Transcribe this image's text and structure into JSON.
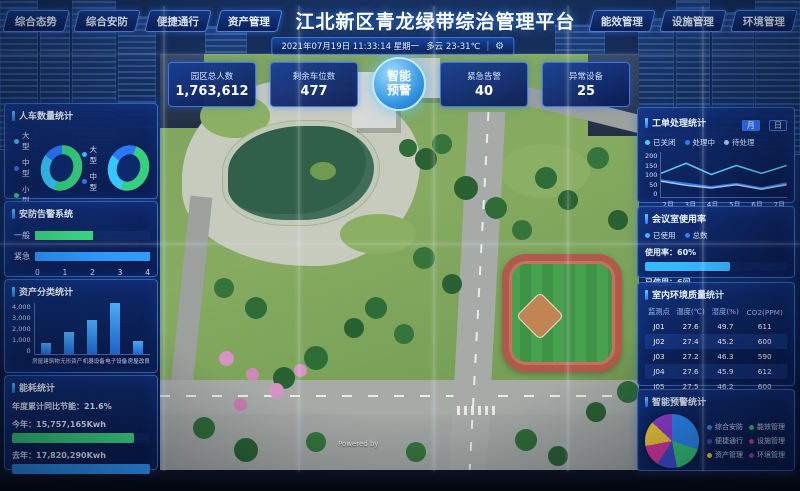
{
  "header": {
    "title": "江北新区青龙绿带综治管理平台",
    "tabs_left": [
      "综合态势",
      "综合安防",
      "便捷通行",
      "资产管理"
    ],
    "tabs_right": [
      "能效管理",
      "设施管理",
      "环境管理"
    ],
    "datetime": "2021年07月19日 11:33:14 星期一",
    "weather": "多云 23-31℃"
  },
  "kpis": {
    "park_total_people": {
      "label": "园区总人数",
      "value": "1,763,612"
    },
    "parking_remaining": {
      "label": "剩余车位数",
      "value": "477"
    },
    "smart_alert": {
      "line1": "智能",
      "line2": "预警"
    },
    "emergency_alarms": {
      "label": "紧急告警",
      "value": "40"
    },
    "abnormal_devices": {
      "label": "异常设备",
      "value": "25"
    }
  },
  "panels": {
    "people_vehicle": {
      "title": "人车数量统计"
    },
    "security_alarm": {
      "title": "安防告警系统"
    },
    "asset_category": {
      "title": "资产分类统计"
    },
    "energy": {
      "title": "能耗统计",
      "yoy": "年度累计同比节能：21.6%",
      "this_year_label": "今年：15,757,165Kwh",
      "last_year_label": "去年：17,820,290Kwh"
    },
    "work_order": {
      "title": "工单处理统计",
      "toggle_month": "月",
      "toggle_day": "日"
    },
    "meeting_room": {
      "title": "会议室使用率",
      "legend_used": "已使用",
      "legend_total": "总数",
      "usage_label": "使用率：60%",
      "used_label": "已使用：6间"
    },
    "indoor_env": {
      "title": "室内环境质量统计"
    },
    "smart_warning": {
      "title": "智能预警统计"
    }
  },
  "map": {
    "watermark": "Powered by"
  },
  "colors": {
    "accent": "#2f6fff",
    "panel_border": "#5f9bff",
    "alert_button": "#3497e2"
  },
  "chart_data": [
    {
      "type": "pie",
      "name": "人车数量统计-车辆左",
      "donut": true,
      "labels": [
        "大型",
        "中型",
        "小型"
      ],
      "values": [
        30,
        15,
        55
      ],
      "colors": [
        "#35c8ff",
        "#2979ff",
        "#35d07f"
      ]
    },
    {
      "type": "pie",
      "name": "人车数量统计-车辆右",
      "donut": true,
      "labels": [
        "大型",
        "中型"
      ],
      "values": [
        30,
        20,
        50
      ],
      "colors": [
        "#35c8ff",
        "#2979ff",
        "#35d07f"
      ]
    },
    {
      "type": "bar",
      "name": "安防告警系统",
      "orientation": "horizontal",
      "categories": [
        "一般",
        "紧急"
      ],
      "values": [
        2,
        4
      ],
      "colors": [
        "#3ddc84",
        "#2f9bff"
      ],
      "xlim": [
        0,
        4
      ],
      "xticks": [
        "0",
        "1",
        "2",
        "3",
        "4"
      ]
    },
    {
      "type": "bar",
      "name": "资产分类统计",
      "categories": [
        "房屋建筑物",
        "无形资产",
        "机器设备",
        "电子设备",
        "房屋改良"
      ],
      "values": [
        900,
        1700,
        2700,
        4000,
        1000
      ],
      "ylim": [
        0,
        4000
      ],
      "yticks": [
        "4,000",
        "3,000",
        "2,000",
        "1,000",
        "0"
      ],
      "color": "#2f9bff"
    },
    {
      "type": "bar",
      "name": "能耗统计",
      "orientation": "horizontal",
      "annotation": "年度累计同比节能：21.6%",
      "categories": [
        "今年",
        "去年"
      ],
      "values": [
        15757165,
        17820290
      ],
      "value_labels": [
        "15,757,165Kwh",
        "17,820,290Kwh"
      ],
      "colors": [
        "#3ddc84",
        "#2f9bff"
      ]
    },
    {
      "type": "line",
      "name": "工单处理统计",
      "categories": [
        "2月",
        "3月",
        "4月",
        "5月",
        "6月",
        "7月"
      ],
      "ylim": [
        0,
        200
      ],
      "yticks": [
        "200",
        "150",
        "100",
        "50",
        "0"
      ],
      "series": [
        {
          "name": "已关闭",
          "color": "#58c9f7",
          "values": [
            105,
            150,
            100,
            140,
            105,
            140
          ]
        },
        {
          "name": "处理中",
          "color": "#2f7bff",
          "values": [
            75,
            60,
            45,
            60,
            40,
            62
          ]
        },
        {
          "name": "待处理",
          "color": "#a9c3e8",
          "values": [
            70,
            52,
            40,
            55,
            35,
            55
          ]
        }
      ]
    },
    {
      "type": "bar",
      "name": "会议室使用率",
      "values": [
        60
      ],
      "xlim": [
        0,
        100
      ],
      "colors": [
        "#36b7ff",
        "#2f7bff"
      ]
    },
    {
      "type": "table",
      "name": "室内环境质量统计",
      "columns": [
        "监测点",
        "温度(℃)",
        "湿度(%)",
        "CO2(PPM)"
      ],
      "rows": [
        [
          "J01",
          "27.6",
          "49.7",
          "611"
        ],
        [
          "J02",
          "27.4",
          "45.2",
          "600"
        ],
        [
          "J03",
          "27.2",
          "46.3",
          "590"
        ],
        [
          "J04",
          "27.6",
          "45.9",
          "612"
        ],
        [
          "J05",
          "27.5",
          "46.2",
          "600"
        ]
      ]
    },
    {
      "type": "pie",
      "name": "智能预警统计",
      "labels": [
        "综合安防",
        "能效管理",
        "便捷通行",
        "设施管理",
        "资产管理",
        "环境管理"
      ],
      "values": [
        30,
        17,
        12,
        13,
        15,
        13
      ],
      "colors": [
        "#2f8fff",
        "#38d07f",
        "#3f51d8",
        "#e338a8",
        "#ffd43a",
        "#9b3fd8"
      ]
    }
  ]
}
